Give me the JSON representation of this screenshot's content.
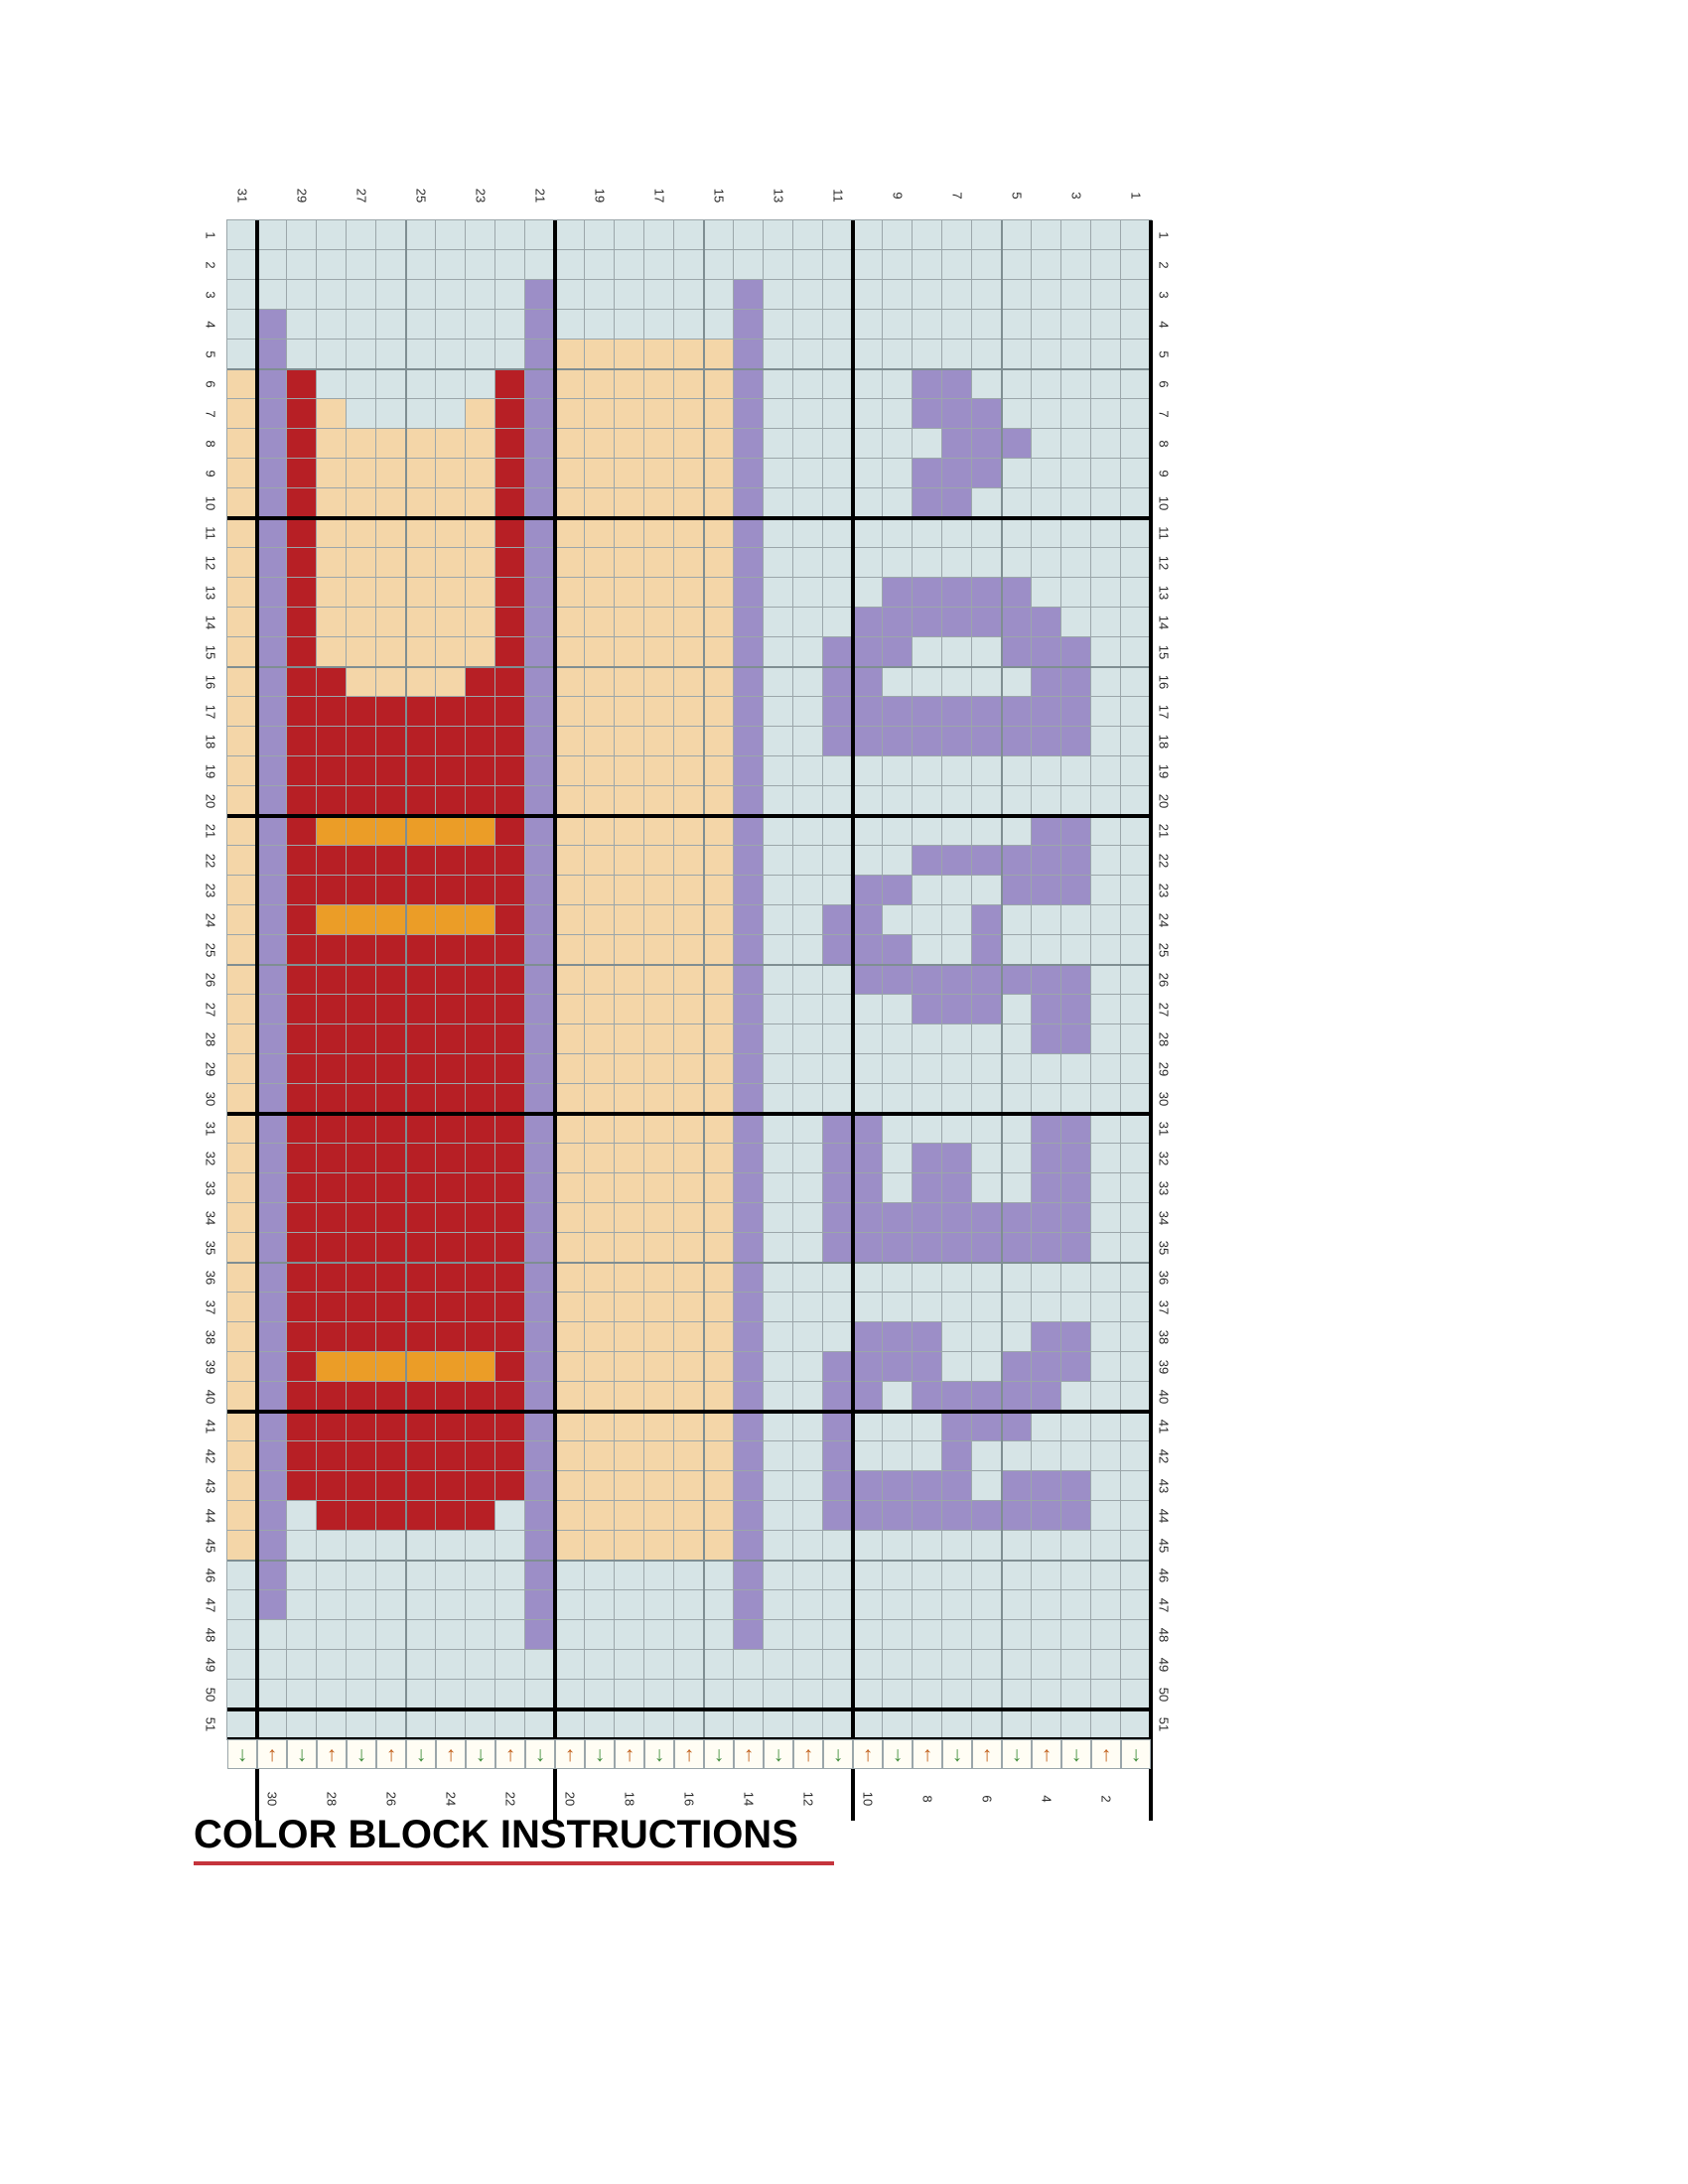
{
  "title": {
    "text": "COLOR BLOCK INSTRUCTIONS",
    "underline_color": "#c5343c"
  },
  "chart_data": {
    "type": "heatmap",
    "grid": {
      "columns": 31,
      "rows": 51
    },
    "top_labels": [
      "31",
      "29",
      "27",
      "25",
      "23",
      "21",
      "19",
      "17",
      "15",
      "13",
      "11",
      "9",
      "7",
      "5",
      "3",
      "1"
    ],
    "bottom_labels": [
      "30",
      "28",
      "26",
      "24",
      "22",
      "20",
      "18",
      "16",
      "14",
      "12",
      "10",
      "8",
      "6",
      "4",
      "2"
    ],
    "row_labels_left": [
      "1",
      "2",
      "3",
      "4",
      "5",
      "6",
      "7",
      "8",
      "9",
      "10",
      "11",
      "12",
      "13",
      "14",
      "15",
      "16",
      "17",
      "18",
      "19",
      "20",
      "21",
      "22",
      "23",
      "24",
      "25",
      "26",
      "27",
      "28",
      "29",
      "30",
      "31",
      "32",
      "33",
      "34",
      "35",
      "36",
      "37",
      "38",
      "39",
      "40",
      "41",
      "42",
      "43",
      "44",
      "45",
      "46",
      "47",
      "48",
      "49",
      "50",
      "51"
    ],
    "row_labels_right": [
      "1",
      "2",
      "3",
      "4",
      "5",
      "6",
      "7",
      "8",
      "9",
      "10",
      "11",
      "12",
      "13",
      "14",
      "15",
      "16",
      "17",
      "18",
      "19",
      "20",
      "21",
      "22",
      "23",
      "24",
      "25",
      "26",
      "27",
      "28",
      "29",
      "30",
      "31",
      "32",
      "33",
      "34",
      "35",
      "36",
      "37",
      "38",
      "39",
      "40",
      "41",
      "42",
      "43",
      "44",
      "45",
      "46",
      "47",
      "48",
      "49",
      "50",
      "51"
    ],
    "palette": {
      "B": "#d6e4e6",
      "H": "#f4d6a8",
      "P": "#9c8ec7",
      "R": "#b71f25",
      "O": "#eb9d27"
    },
    "palette_names": {
      "B": "light-blue-background",
      "H": "cream-peach",
      "P": "purple",
      "R": "dark-red",
      "O": "orange"
    },
    "cells": [
      "BBBBBBBBBBBBBBBBBBBBBBBBBBBBBBB",
      "BBBBBBBBBBBBBBBBBBBBBBBBBBBBBBB",
      "BBBBBBBBBBPBBBBBBPBBBBBBBBBBBBB",
      "BPBBBBBBBBPBBBBBBPBBBBBBBBBBBBB",
      "BPBBBBBBBBPHHHHHHPBBBBBBBBBBBBB",
      "HPRBBBBBBRPHHHHHHPBBBBBPPBBBBBB",
      "HPRHBBBBHRPHHHHHHPBBBBBPPPBBBBB",
      "HPRHHHHHHRPHHHHHHPBBBBBBPPPBBBB",
      "HPRHHHHHHRPHHHHHHPBBBBBPPPBBBBB",
      "HPRHHHHHHRPHHHHHHPBBBBBPPBBBBBB",
      "HPRHHHHHHRPHHHHHHPBBBBBBBBBBBBB",
      "HPRHHHHHHRPHHHHHHPBBBBBBBBBBBBB",
      "HPRHHHHHHRPHHHHHHPBBBBPPPPPBBBB",
      "HPRHHHHHHRPHHHHHHPBBBPPPPPPPBBB",
      "HPRHHHHHHRPHHHHHHPBBPPPBBBPPPBB",
      "HPRRHHHHRRPHHHHHHPBBPPBBBBBPPBB",
      "HPRRRRRRRRPHHHHHHPBBPPPPPPPPPBB",
      "HPRRRRRRRRPHHHHHHPBBPPPPPPPPPBB",
      "HPRRRRRRRRPHHHHHHPBBBBBBBBBBBBB",
      "HPRRRRRRRRPHHHHHHPBBBBBBBBBBBBB",
      "HPROOOOOORPHHHHHHPBBBBBBBBBPPBB",
      "HPRRRRRRRRPHHHHHHPBBBBBPPPPPPBB",
      "HPRRRRRRRRPHHHHHHPBBBPPBBBPPPBB",
      "HPROOOOOORPHHHHHHPBBPPBBBPBBBBB",
      "HPRRRRRRRRPHHHHHHPBBPPPBBPBBBBB",
      "HPRRRRRRRRPHHHHHHPBBBPPPPPPPPBB",
      "HPRRRRRRRRPHHHHHHPBBBBBPPPBPPBB",
      "HPRRRRRRRRPHHHHHHPBBBBBBBBBPPBB",
      "HPRRRRRRRRPHHHHHHPBBBBBBBBBBBBB",
      "HPRRRRRRRRPHHHHHHPBBBBBBBBBBBBB",
      "HPRRRRRRRRPHHHHHHPBBPPBBBBBPPBB",
      "HPRRRRRRRRPHHHHHHPBBPPBPPBBPPBB",
      "HPRRRRRRRRPHHHHHHPBBPPBPPBBPPBB",
      "HPRRRRRRRRPHHHHHHPBBPPPPPPPPPBB",
      "HPRRRRRRRRPHHHHHHPBBPPPPPPPPPBB",
      "HPRRRRRRRRPHHHHHHPBBBBBBBBBBBBB",
      "HPRRRRRRRRPHHHHHHPBBBBBBBBBBBBB",
      "HPRRRRRRRRPHHHHHHPBBBPPPBBBPPBB",
      "HPROOOOOORPHHHHHHPBBPPPPBBPPPBB",
      "HPRRRRRRRRPHHHHHHPBBPPBPPPPPBBB",
      "HPRRRRRRRRPHHHHHHPBBPBBBPPPBBBB",
      "HPRRRRRRRRPHHHHHHPBBPBBBPBBBBBB",
      "HPRRRRRRRRPHHHHHHPBBPPPPPBPPPBB",
      "HPBRRRRRRBPHHHHHHPBBPPPPPPPPPBB",
      "HPBBBBBBBBPHHHHHHPBBBBBBBBBBBBB",
      "BPBBBBBBBBPBBBBBBPBBBBBBBBBBBBB",
      "BPBBBBBBBBPBBBBBBPBBBBBBBBBBBBB",
      "BBBBBBBBBBPBBBBBBPBBBBBBBBBBBBB",
      "BBBBBBBBBBBBBBBBBBBBBBBBBBBBBBB",
      "BBBBBBBBBBBBBBBBBBBBBBBBBBBBBBB",
      "BBBBBBBBBBBBBBBBBBBBBBBBBBBBBBB"
    ],
    "arrow_row": {
      "pattern": "DUDUDUDUDUDUDUDUDUDUDUDUDUDUDUD",
      "down_glyph": "↓",
      "up_glyph": "↑",
      "down_color": "#44903e",
      "up_color": "#c2611c"
    },
    "gridline_color": "#9ba6aa",
    "heavy_line_color": "#000000",
    "legend_position": "none",
    "grid_on": true
  }
}
